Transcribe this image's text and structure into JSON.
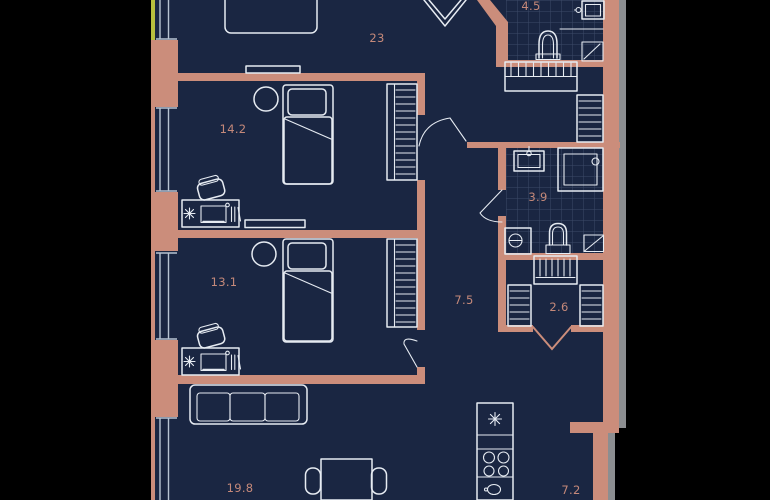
{
  "plan": {
    "type": "apartment-floor-plan",
    "rooms": [
      {
        "id": "living-bedroom",
        "label": "23"
      },
      {
        "id": "bedroom-1",
        "label": "14.2"
      },
      {
        "id": "bedroom-2",
        "label": "13.1"
      },
      {
        "id": "hallway",
        "label": "7.5"
      },
      {
        "id": "bathroom-1",
        "label": "4.5"
      },
      {
        "id": "bathroom-2",
        "label": "3.9"
      },
      {
        "id": "wardrobe-closet",
        "label": "2.6"
      },
      {
        "id": "living-dining",
        "label": "19.8"
      },
      {
        "id": "kitchen",
        "label": "7.2"
      }
    ],
    "icons": {
      "fridge": "snowflake-icon",
      "stove": "four-burners-icon",
      "washer": "circle-dash-icon",
      "desk_plant": "asterisk-icon",
      "entry": "chevron-door-icon"
    },
    "colors": {
      "bg": "#000000",
      "floor": "#1a2642",
      "wall": "#cb8d7b",
      "line": "#e6ebf2",
      "glass": "#b7c3d2",
      "tile": "#3c4a68",
      "label": "#c5897a",
      "frame": "#8c8e91",
      "accent": "#b8bf3e"
    }
  }
}
